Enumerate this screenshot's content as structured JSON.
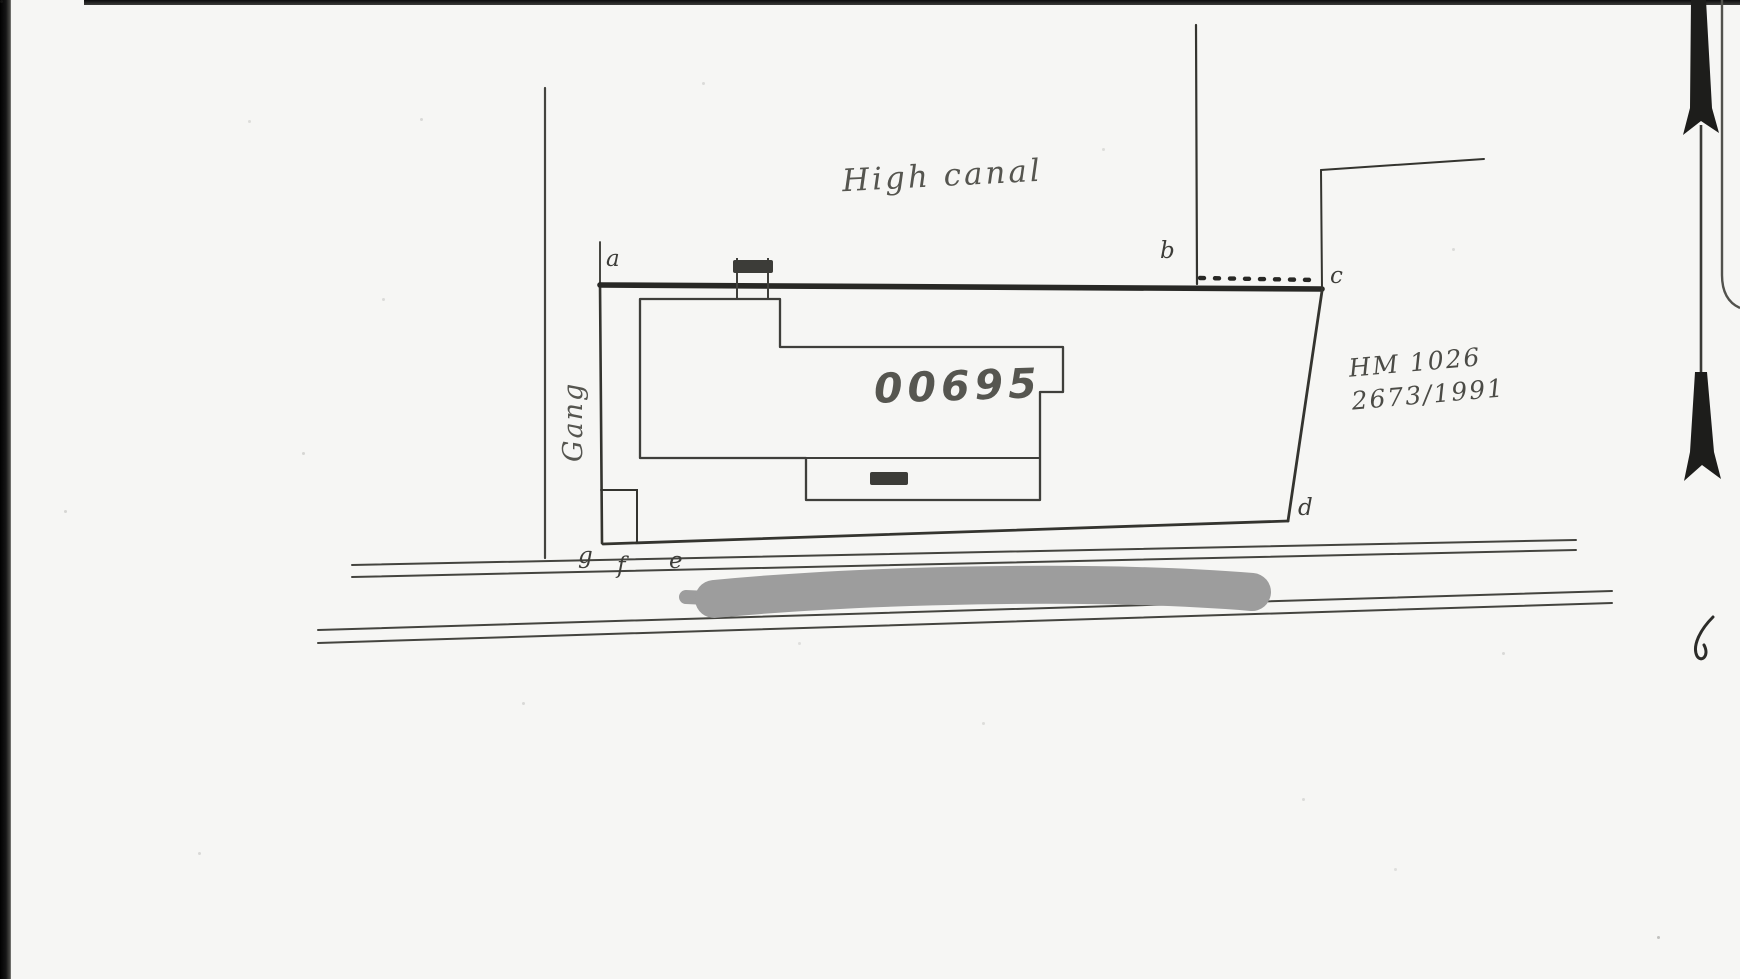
{
  "colors": {
    "paper": "#f6f6f4",
    "ink": "#3f3f3b",
    "boundary_ink": "#2b2b28",
    "scan_border": "#0c0c0c",
    "redaction": "#9d9d9d"
  },
  "labels": {
    "canal": "High canal",
    "alley": "Gang",
    "parcel_number": "00695",
    "reference": [
      "HM 1026",
      "2673/1991"
    ]
  },
  "vertices": [
    "a",
    "b",
    "c",
    "d",
    "e",
    "f",
    "g"
  ]
}
